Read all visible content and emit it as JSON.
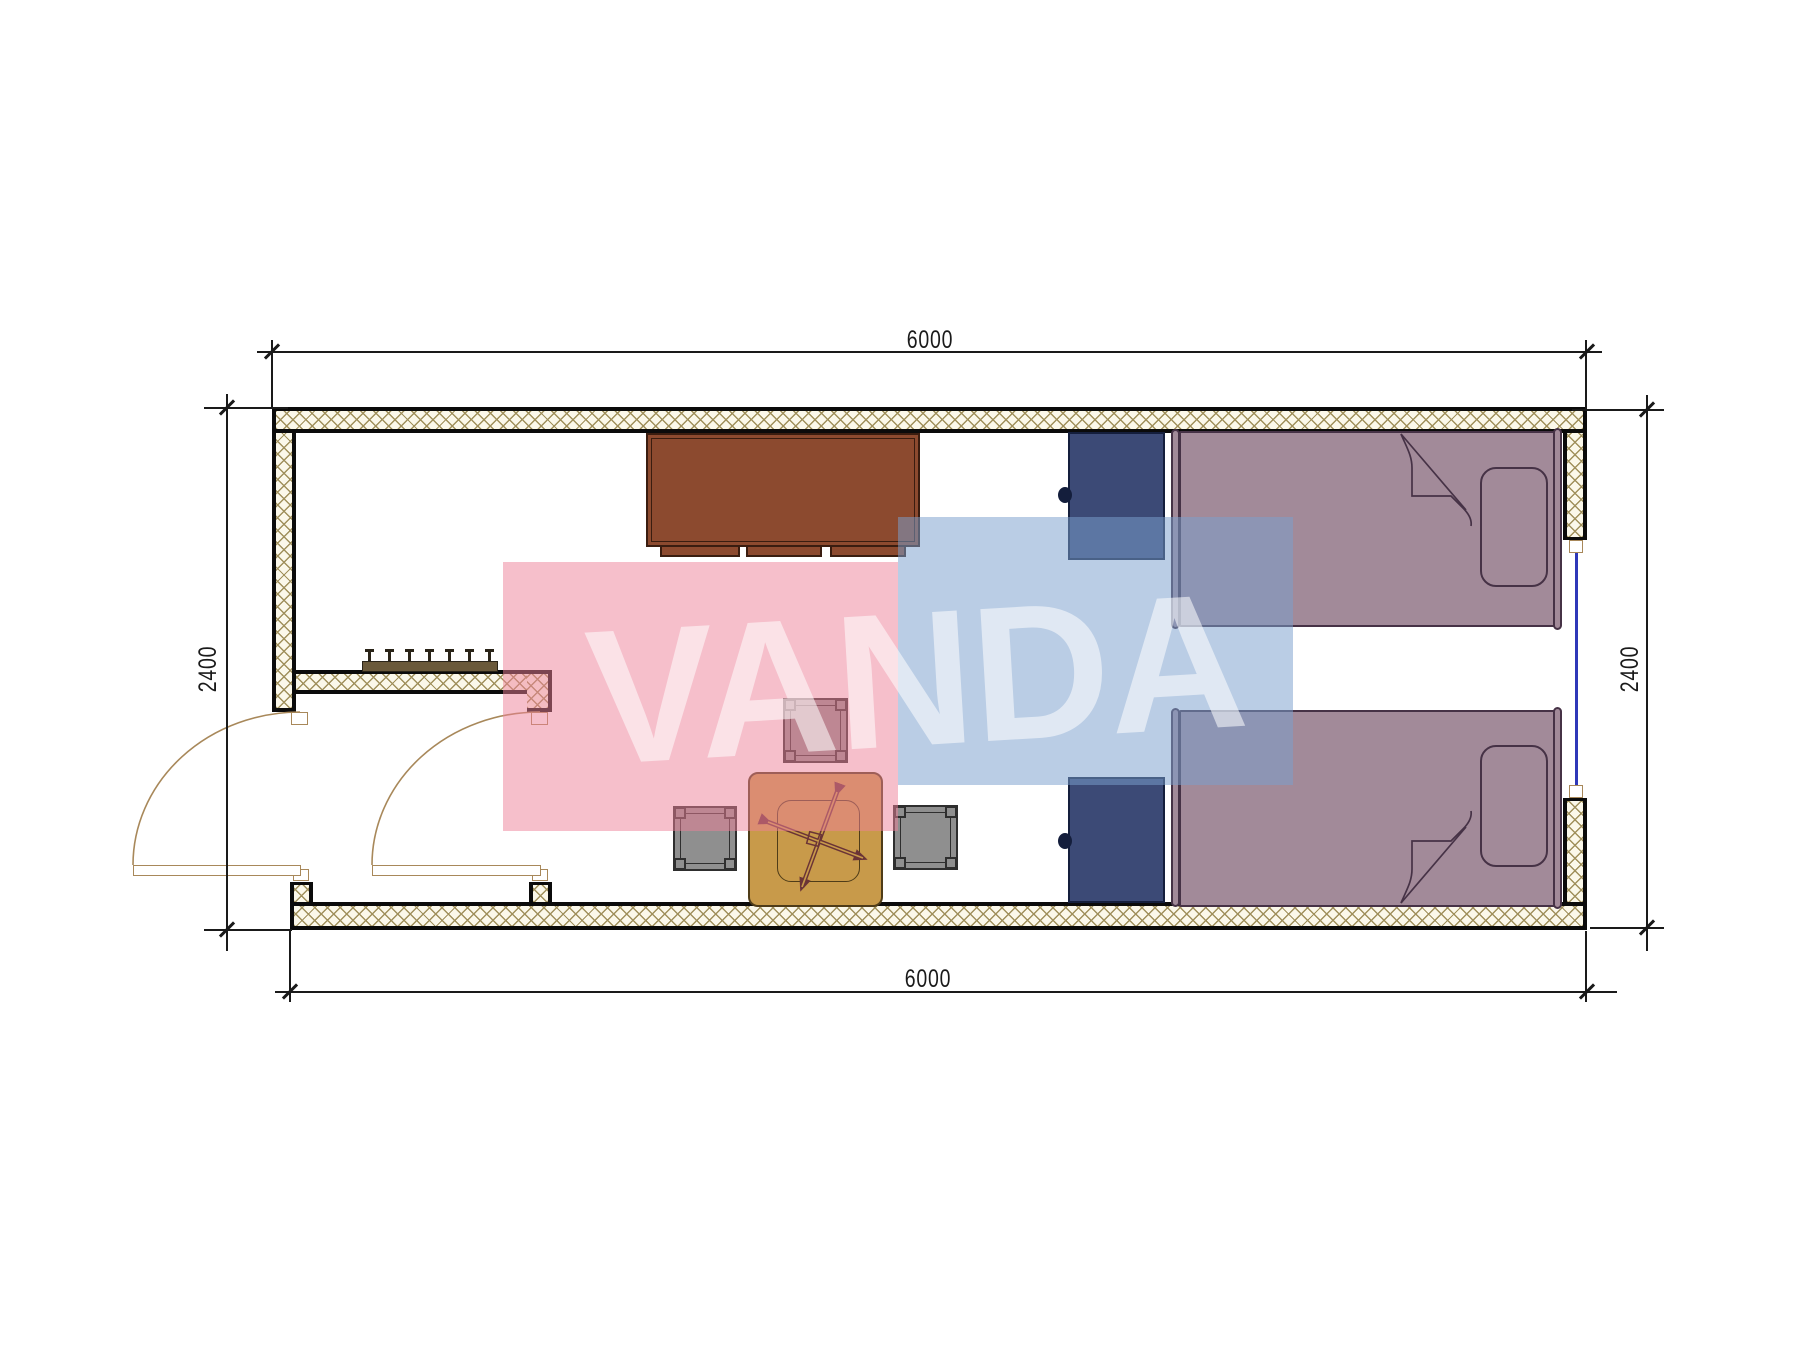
{
  "drawing": {
    "kind": "container-house floor plan"
  },
  "dimensions": {
    "top": "6000",
    "bottom": "6000",
    "left": "2400",
    "right": "2400"
  },
  "watermark": {
    "text": "VANDA",
    "pink": "rgba(238,128,152,0.50)",
    "blue": "rgba(122,160,205,0.52)",
    "letters": "rgba(255,255,255,0.55)"
  },
  "colors": {
    "wall_bg": "#fbf8ea",
    "wall_hatch": "#a0905c",
    "wall_line": "#0b0b0b",
    "sill_border": "#a8885a",
    "door_line": "#a8885a",
    "window_glass": "#2e38b8",
    "rack_fill": "#6a593a",
    "rack_line": "#2a2418",
    "desk_fill": "#8c4a2f",
    "desk_line": "#3a1d10",
    "nightstand_fill": "#3c4a76",
    "nightstand_line": "#141e3c",
    "bed_fill": "#a28a99",
    "bed_line": "#463246",
    "table_fill": "#c89a4a",
    "table_line": "#4f3c18",
    "mech": "#6a3336",
    "stool_fill": "#8f8f8f",
    "stool_line": "#2e2e2e",
    "dim_line": "#1a1a1a",
    "dim_text": "#1a1a1a"
  }
}
